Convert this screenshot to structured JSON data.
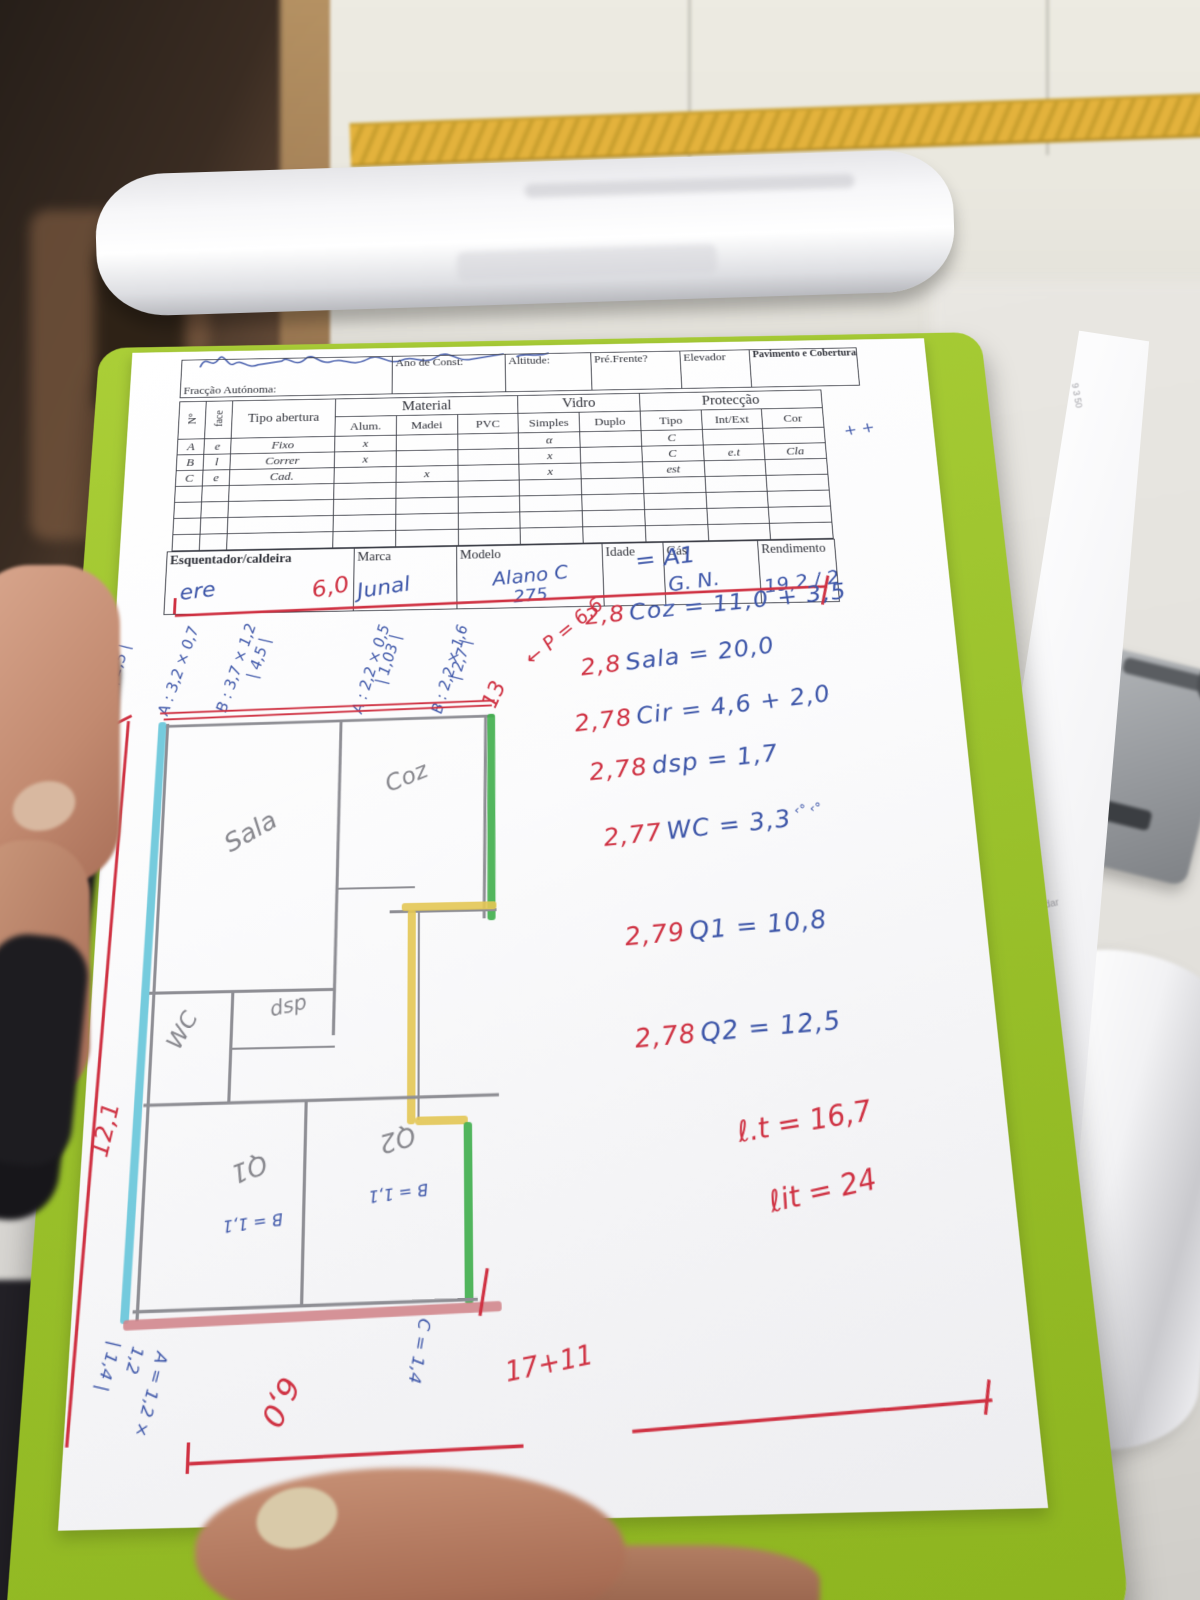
{
  "form": {
    "header": {
      "fields": [
        "Fracção Autónoma:",
        "Ano de Const:",
        "Altitude:",
        "Pré.Frente?",
        "Elevador",
        "Pavimento e Cobertura"
      ]
    },
    "openings_table": {
      "group_headers": [
        "Material",
        "Vidro",
        "Protecção"
      ],
      "columns": [
        "N°",
        "face",
        "Tipo abertura",
        "Alum.",
        "Madei",
        "PVC",
        "Simples",
        "Duplo",
        "Tipo",
        "Int/Ext",
        "Cor"
      ],
      "rows": [
        {
          "n": "A",
          "face": "e",
          "tipo": "Fixo",
          "alum": "x",
          "madei": "",
          "pvc": "",
          "simples": "α",
          "duplo": "",
          "prot_tipo": "C",
          "int_ext": "",
          "cor": ""
        },
        {
          "n": "B",
          "face": "l",
          "tipo": "Correr",
          "alum": "x",
          "madei": "",
          "pvc": "",
          "simples": "x",
          "duplo": "",
          "prot_tipo": "C",
          "int_ext": "e.t",
          "cor": "Cla"
        },
        {
          "n": "C",
          "face": "e",
          "tipo": "Cad.",
          "alum": "",
          "madei": "x",
          "pvc": "",
          "simples": "x",
          "duplo": "",
          "prot_tipo": "est",
          "int_ext": "",
          "cor": ""
        }
      ],
      "margin_marks": "+ +"
    },
    "heater_table": {
      "row_label": "Esquentador/caldeira",
      "columns": [
        "Marca",
        "Modelo",
        "Idade",
        "Gás",
        "Rendimento"
      ],
      "handwritten": {
        "label_cell": "ere",
        "marca": "Junal",
        "modelo": "Alano C",
        "modelo_line2": "275",
        "idade": "",
        "gas": "G. N.",
        "rendimento": "19,2 / 22,7"
      }
    }
  },
  "notes": {
    "sum_marker": "= A1",
    "calc_lines": [
      {
        "coef": "2,8",
        "body": "Coz = 11,0 + 3,5",
        "suffix": ""
      },
      {
        "coef": "2,8",
        "body": "Sala = 20,0",
        "suffix": ""
      },
      {
        "coef": "2,78",
        "body": "Cir = 4,6 + 2,0",
        "suffix": ""
      },
      {
        "coef": "2,78",
        "body": "dsp = 1,7",
        "suffix": ""
      },
      {
        "coef": "2,77",
        "body": "WC = 3,3",
        "suffix": "‹° ‹°"
      },
      {
        "coef": "2,79",
        "body": "Q1 = 10,8",
        "suffix": ""
      },
      {
        "coef": "2,78",
        "body": "Q2 = 12,5",
        "suffix": ""
      }
    ],
    "totals": [
      "ℓ.t = 16,7",
      "ℓit = 24"
    ]
  },
  "plan": {
    "rooms": [
      "Sala",
      "Coz",
      "WC",
      "dsp",
      "Q1",
      "Q2"
    ],
    "room_dims": {
      "b11_left": "B = 1,1",
      "b11_right": "B = 1,1"
    },
    "dims": {
      "top_width": "6,0",
      "left_height": "12,1",
      "bottom_sum": "17+11",
      "thirteen": "13",
      "p_total": "← P = 6,6",
      "bottom_60": "6,0",
      "win_a1": "A : 3,2 × 0,7",
      "win_a1_t": "| 2,5 |",
      "win_b1": "B : 3,7 × 1,2",
      "win_b1_t": "| 4,5 |",
      "win_a2": "A : 2,2 × 0,5",
      "win_a2_t": "| 1,03 |",
      "win_b2": "B : 2,2 × 1,6",
      "win_b2_t": "| 2,7 |",
      "win_a3": "A = 1,2 ×",
      "win_a3b": "1,2",
      "win_a3_t": "| 1,4 |",
      "win_c": "C = 1,4"
    }
  },
  "background": {
    "faint_print": [
      "ambos guardar",
      "MobDedProdCart v.5",
      "9 3 50"
    ]
  }
}
